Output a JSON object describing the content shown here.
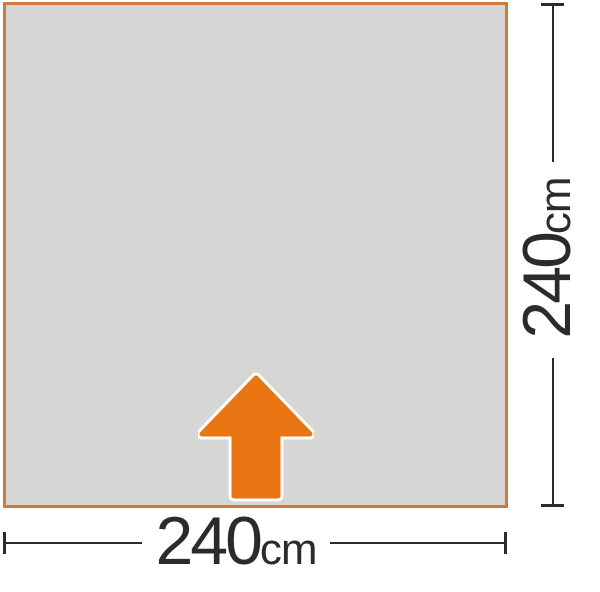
{
  "diagram": {
    "type": "footprint-dimension-diagram",
    "dimensions": {
      "width": {
        "value": "240",
        "unit": "cm"
      },
      "height": {
        "value": "240",
        "unit": "cm"
      }
    },
    "icons": {
      "entrance_arrow": "up-arrow-icon"
    },
    "colors": {
      "footprint_fill": "#d6d6d4",
      "footprint_border": "#cc7b3d",
      "arrow_fill": "#ea7613",
      "arrow_outline": "#ffffff",
      "dimension_line": "#2b2b29",
      "background": "#ffffff"
    }
  }
}
